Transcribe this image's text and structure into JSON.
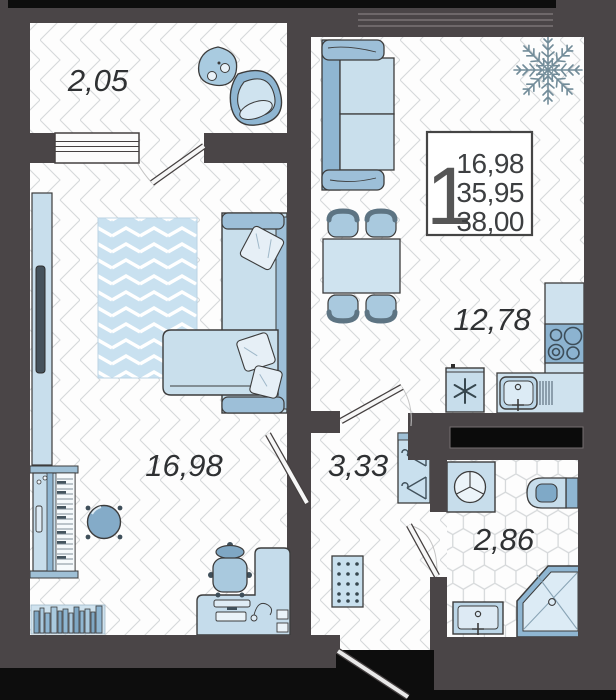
{
  "plan": {
    "title": "1-room apartment floor plan",
    "badge": {
      "rooms_count": "1",
      "living_area": "16,98",
      "apartment_area": "35,95",
      "total_area": "38,00"
    },
    "rooms": {
      "balcony": {
        "name": "balcony",
        "area": "2,05"
      },
      "living": {
        "name": "living room",
        "area": "16,98"
      },
      "kitchen": {
        "name": "kitchen-living",
        "area": "12,78"
      },
      "hallway": {
        "name": "hallway",
        "area": "3,33"
      },
      "bathroom": {
        "name": "bathroom",
        "area": "2,86"
      }
    },
    "colors": {
      "wall": "#4a4547",
      "outside_black": "#0d0d0d",
      "floor": "#fdfdfd",
      "floor_line": "#d5d8da",
      "furniture_light": "#c8deec",
      "furniture_lighter": "#ddeaf4",
      "furniture_medium": "#93b8d3",
      "furniture_dark": "#7fa7c4",
      "outline": "#3c3c3c",
      "label_text": "#2f3133"
    },
    "icons": {
      "freezer": "asterisk-icon",
      "plant": "fern-plant-icon",
      "hangers": "clothes-hanger-icon"
    }
  }
}
